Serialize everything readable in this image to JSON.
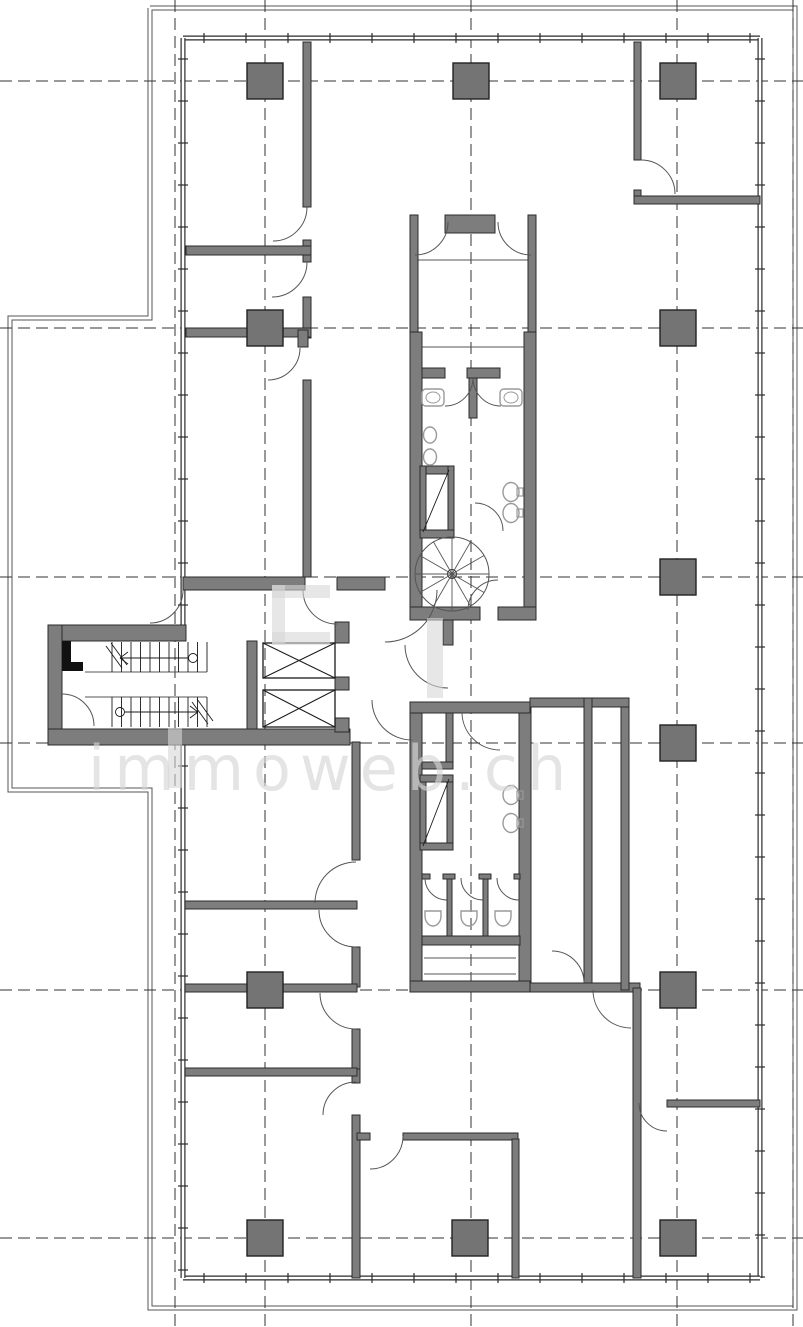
{
  "plan": {
    "title": "floor-plan",
    "canvas": {
      "w": 803,
      "h": 1327
    },
    "palette": {
      "bg": "#ffffff",
      "wall_fill": "#7d7d7d",
      "wall_stroke": "#2b2b2b",
      "line": "#1a1a1a",
      "thin": "#555555",
      "fixture": "#9a9a9a",
      "column_fill": "#747474",
      "grid": "#333333",
      "boundary": "#555555",
      "watermark": "#d7d7d7"
    },
    "grid": {
      "vx": [
        175,
        265,
        471,
        677,
        793
      ],
      "hy": [
        81,
        328,
        577,
        743,
        990,
        1238
      ],
      "dash": "12 6"
    },
    "site_boundary": "150,8 795,8 795,1308 150,1308 150,790 10,790 10,318 150,318 150,8",
    "exterior_walls": [
      [
        183,
        38,
        760,
        38
      ],
      [
        760,
        38,
        760,
        1278
      ],
      [
        183,
        1278,
        760,
        1278
      ],
      [
        183,
        38,
        183,
        625
      ],
      [
        183,
        745,
        183,
        1278
      ]
    ],
    "tick_step": 42,
    "tick_offset": 21,
    "column_size": 36,
    "columns": [
      [
        265,
        81
      ],
      [
        471,
        81
      ],
      [
        678,
        81
      ],
      [
        265,
        328
      ],
      [
        678,
        328
      ],
      [
        678,
        577
      ],
      [
        678,
        743
      ],
      [
        265,
        990
      ],
      [
        678,
        990
      ],
      [
        265,
        1238
      ],
      [
        470,
        1238
      ],
      [
        678,
        1238
      ]
    ],
    "walls": [
      [
        48,
        625,
        138,
        16
      ],
      [
        48,
        625,
        14,
        120
      ],
      [
        48,
        729,
        302,
        16
      ],
      [
        247,
        641,
        10,
        88
      ],
      [
        335,
        622,
        14,
        21
      ],
      [
        335,
        677,
        14,
        13
      ],
      [
        335,
        718,
        14,
        14
      ],
      [
        303,
        42,
        8,
        165
      ],
      [
        303,
        240,
        8,
        22
      ],
      [
        303,
        297,
        8,
        41
      ],
      [
        303,
        380,
        8,
        197
      ],
      [
        186,
        246,
        125,
        9
      ],
      [
        186,
        328,
        125,
        9
      ],
      [
        298,
        330,
        10,
        17
      ],
      [
        183,
        577,
        122,
        13
      ],
      [
        337,
        577,
        48,
        13
      ],
      [
        443,
        620,
        10,
        25
      ],
      [
        410,
        215,
        8,
        10
      ],
      [
        445,
        215,
        50,
        18
      ],
      [
        528,
        215,
        8,
        10
      ],
      [
        410,
        215,
        8,
        117
      ],
      [
        528,
        215,
        8,
        117
      ],
      [
        410,
        332,
        12,
        288
      ],
      [
        524,
        332,
        12,
        288
      ],
      [
        422,
        368,
        23,
        10
      ],
      [
        467,
        368,
        33,
        10
      ],
      [
        469,
        378,
        8,
        40
      ],
      [
        420,
        466,
        34,
        8
      ],
      [
        420,
        466,
        6,
        70
      ],
      [
        448,
        466,
        6,
        70
      ],
      [
        420,
        530,
        34,
        8
      ],
      [
        410,
        607,
        70,
        13
      ],
      [
        498,
        607,
        38,
        13
      ],
      [
        410,
        702,
        12,
        290
      ],
      [
        519,
        702,
        12,
        290
      ],
      [
        410,
        702,
        120,
        11
      ],
      [
        410,
        981,
        120,
        11
      ],
      [
        446,
        713,
        7,
        55
      ],
      [
        422,
        762,
        31,
        7
      ],
      [
        420,
        775,
        6,
        75
      ],
      [
        447,
        775,
        6,
        75
      ],
      [
        420,
        775,
        33,
        7
      ],
      [
        420,
        843,
        33,
        7
      ],
      [
        447,
        876,
        5,
        60
      ],
      [
        483,
        876,
        5,
        60
      ],
      [
        422,
        874,
        8,
        5
      ],
      [
        443,
        874,
        12,
        5
      ],
      [
        479,
        874,
        12,
        5
      ],
      [
        514,
        874,
        6,
        5
      ],
      [
        422,
        936,
        98,
        9
      ],
      [
        530,
        698,
        99,
        9
      ],
      [
        584,
        698,
        8,
        294
      ],
      [
        530,
        983,
        110,
        9
      ],
      [
        621,
        707,
        8,
        283
      ],
      [
        633,
        988,
        8,
        290
      ],
      [
        352,
        742,
        8,
        118
      ],
      [
        352,
        947,
        8,
        40
      ],
      [
        352,
        1029,
        8,
        42
      ],
      [
        352,
        1069,
        8,
        14
      ],
      [
        352,
        1115,
        8,
        163
      ],
      [
        185,
        901,
        172,
        8
      ],
      [
        185,
        984,
        172,
        8
      ],
      [
        185,
        1068,
        172,
        8
      ],
      [
        357,
        1133,
        13,
        7
      ],
      [
        403,
        1133,
        115,
        7
      ],
      [
        512,
        1139,
        7,
        139
      ],
      [
        634,
        42,
        7,
        118
      ],
      [
        634,
        190,
        7,
        14
      ],
      [
        634,
        196,
        126,
        8
      ],
      [
        667,
        1100,
        93,
        7
      ]
    ],
    "black_accents": [
      [
        62,
        641,
        9,
        30
      ],
      [
        62,
        662,
        21,
        9
      ]
    ],
    "elevators": [
      [
        263,
        643,
        72,
        35
      ],
      [
        263,
        690,
        72,
        37
      ]
    ],
    "thin_lines": [
      [
        422,
        347,
        524,
        347
      ],
      [
        85,
        672,
        207,
        672
      ],
      [
        85,
        697,
        207,
        697
      ],
      [
        424,
        958,
        516,
        958
      ],
      [
        424,
        974,
        516,
        974
      ],
      [
        418,
        260,
        528,
        260
      ]
    ],
    "duct_diagonals": [
      [
        423,
        532,
        449,
        470
      ],
      [
        423,
        846,
        449,
        779
      ]
    ],
    "stair": {
      "treads": {
        "x0": 112,
        "x1": 207,
        "step": 9.5,
        "flights_y": [
          [
            642,
            672
          ],
          [
            697,
            727
          ]
        ]
      },
      "arrow_circles": [
        [
          193,
          658,
          4.5
        ],
        [
          120,
          712,
          4.5
        ]
      ],
      "arrow_lines": [
        [
          188,
          658,
          120,
          658
        ],
        [
          125,
          712,
          198,
          712
        ]
      ],
      "chevrons": [
        [
          120,
          658,
          128,
          652
        ],
        [
          120,
          658,
          128,
          664
        ],
        [
          198,
          712,
          190,
          706
        ],
        [
          198,
          712,
          190,
          718
        ]
      ],
      "breaks": [
        [
          106,
          646,
          122,
          668
        ],
        [
          111,
          643,
          127,
          665
        ],
        [
          192,
          702,
          208,
          724
        ],
        [
          197,
          699,
          213,
          721
        ]
      ]
    },
    "spiral": {
      "cx": 452,
      "cy": 574,
      "r": 37,
      "hub": 4.5,
      "spokes": 12
    },
    "door_arcs": [
      [
        415,
        222,
        33,
        0,
        90
      ],
      [
        531,
        222,
        33,
        90,
        180
      ],
      [
        273,
        207,
        34,
        0,
        90
      ],
      [
        272,
        262,
        35,
        0,
        90
      ],
      [
        268,
        348,
        32,
        0,
        90
      ],
      [
        641,
        194,
        34,
        270,
        360
      ],
      [
        150,
        590,
        33,
        0,
        90
      ],
      [
        385,
        590,
        52,
        0,
        90
      ],
      [
        337,
        590,
        34,
        90,
        180
      ],
      [
        448,
        645,
        43,
        90,
        180
      ],
      [
        412,
        700,
        40,
        90,
        180
      ],
      [
        498,
        610,
        30,
        180,
        270
      ],
      [
        445,
        378,
        28,
        0,
        90
      ],
      [
        501,
        378,
        28,
        90,
        180
      ],
      [
        475,
        531,
        28,
        270,
        360
      ],
      [
        500,
        712,
        38,
        90,
        180
      ],
      [
        447,
        878,
        22,
        90,
        180
      ],
      [
        483,
        878,
        22,
        90,
        180
      ],
      [
        519,
        878,
        22,
        90,
        180
      ],
      [
        552,
        983,
        32,
        270,
        360
      ],
      [
        631,
        990,
        38,
        90,
        180
      ],
      [
        356,
        903,
        41,
        180,
        270
      ],
      [
        356,
        910,
        37,
        90,
        180
      ],
      [
        356,
        993,
        36,
        90,
        180
      ],
      [
        356,
        1115,
        33,
        180,
        270
      ],
      [
        370,
        1136,
        33,
        0,
        90
      ],
      [
        667,
        1103,
        28,
        90,
        180
      ],
      [
        62,
        726,
        32,
        270,
        360
      ]
    ],
    "fixtures": {
      "sinks": [
        [
          422,
          389,
          22,
          17
        ],
        [
          500,
          389,
          22,
          17
        ]
      ],
      "urinals": [
        [
          430,
          435
        ],
        [
          430,
          457
        ]
      ],
      "wall_toilets": [
        [
          511,
          492
        ],
        [
          511,
          513
        ],
        [
          511,
          795
        ],
        [
          511,
          823
        ]
      ],
      "floor_toilets": [
        [
          433,
          916
        ],
        [
          469,
          916
        ],
        [
          503,
          916
        ]
      ]
    },
    "watermark": {
      "text": "immoweb.ch",
      "x": 88,
      "y": 790,
      "size": 62,
      "spacing": 9,
      "shapes": [
        [
          272,
          585,
          58,
          13
        ],
        [
          272,
          585,
          13,
          60
        ],
        [
          272,
          632,
          58,
          13
        ],
        [
          427,
          618,
          16,
          80
        ],
        [
          168,
          728,
          14,
          60
        ]
      ]
    }
  }
}
